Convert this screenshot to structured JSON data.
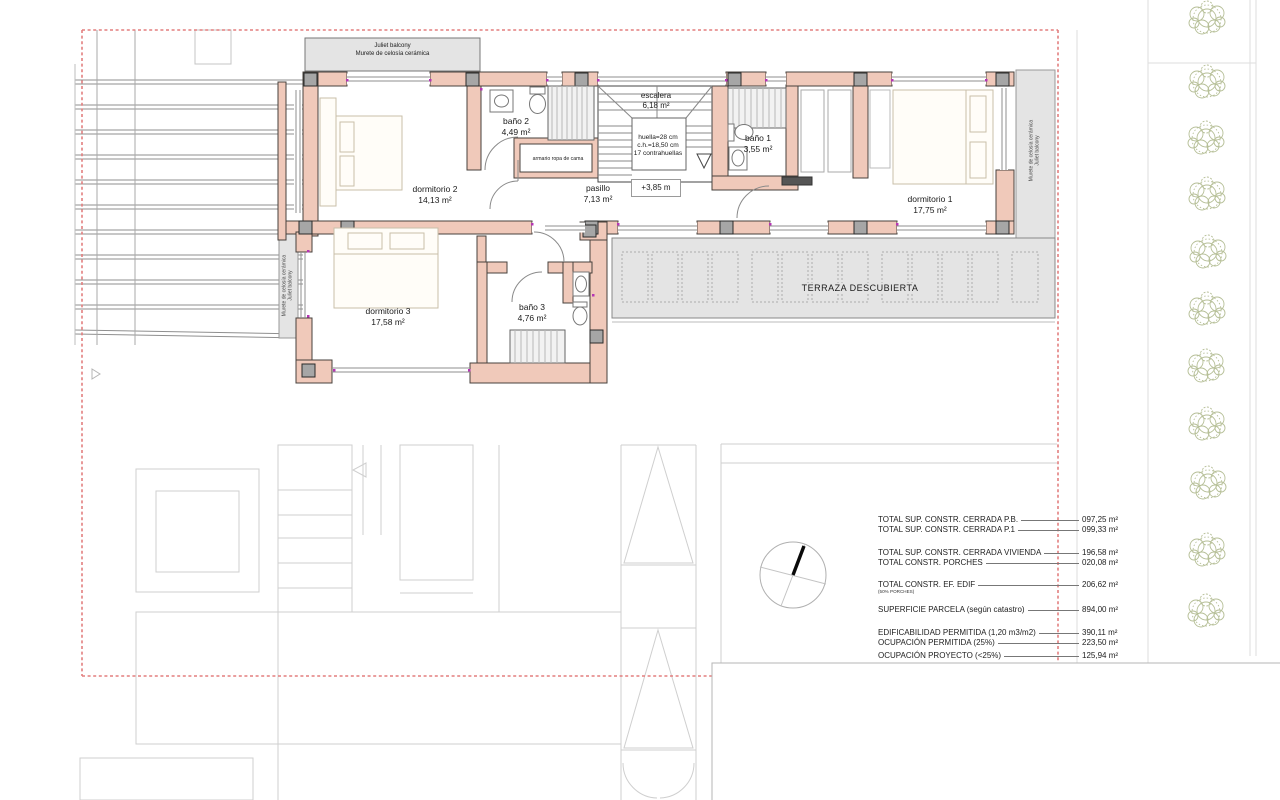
{
  "plan": {
    "balcony_top": {
      "line1": "Juliet balcony",
      "line2": "Murete de celosía cerámica"
    },
    "balcony_left": {
      "line1": "Murete de celosía cerámica",
      "line2": "Juliet balcony"
    },
    "balcony_right": {
      "line1": "Murete de celosía cerámica",
      "line2": "Juliet balcony"
    },
    "rooms": {
      "dormitorio2": {
        "name": "dormitorio 2",
        "area": "14,13 m²"
      },
      "bano2": {
        "name": "baño 2",
        "area": "4,49 m²"
      },
      "escalera": {
        "name": "escalera",
        "area": "6,18 m²"
      },
      "bano1": {
        "name": "baño 1",
        "area": "3,55 m²"
      },
      "dormitorio1": {
        "name": "dormitorio 1",
        "area": "17,75 m²"
      },
      "pasillo": {
        "name": "pasillo",
        "area": "7,13 m²"
      },
      "dormitorio3": {
        "name": "dormitorio 3",
        "area": "17,58 m²"
      },
      "bano3": {
        "name": "baño 3",
        "area": "4,76 m²"
      },
      "terraza": {
        "name": "TERRAZA DESCUBIERTA"
      }
    },
    "stair_note": {
      "line1": "huella=28 cm",
      "line2": "c.h.=18,50 cm",
      "line3": "17 contrahuellas"
    },
    "level_mark": "+3,85 m",
    "closet_label": "armario ropa de cama"
  },
  "summary_table": {
    "rows": [
      {
        "label": "TOTAL SUP. CONSTR. CERRADA P.B.",
        "value": "097,25 m²"
      },
      {
        "label": "TOTAL SUP. CONSTR. CERRADA P.1",
        "value": "099,33 m²"
      },
      {
        "label": "TOTAL SUP. CONSTR. CERRADA VIVIENDA",
        "value": "196,58 m²"
      },
      {
        "label": "TOTAL  CONSTR. PORCHES",
        "value": "020,08 m²"
      },
      {
        "label": "TOTAL  CONSTR.  EF. EDIF",
        "value": "206,62 m²",
        "sub": "(50% PORCHES)"
      },
      {
        "label": "SUPERFICIE PARCELA (según catastro)",
        "value": "894,00 m²"
      },
      {
        "label": "EDIFICABILIDAD PERMITIDA (1,20 m3/m2)",
        "value": "390,11 m²"
      },
      {
        "label": "OCUPACIÓN PERMITIDA (25%)",
        "value": "223,50 m²"
      },
      {
        "label": "OCUPACIÓN PROYECTO (<25%)",
        "value": "125,94 m²"
      }
    ]
  },
  "colors": {
    "wall": "#f0c9ba",
    "column": "#a6a6a6",
    "terrace": "#e4e4e4",
    "boundary_dash": "#e37f7f",
    "tree": "#b6bf97",
    "corner_dot": "#b535b5"
  }
}
